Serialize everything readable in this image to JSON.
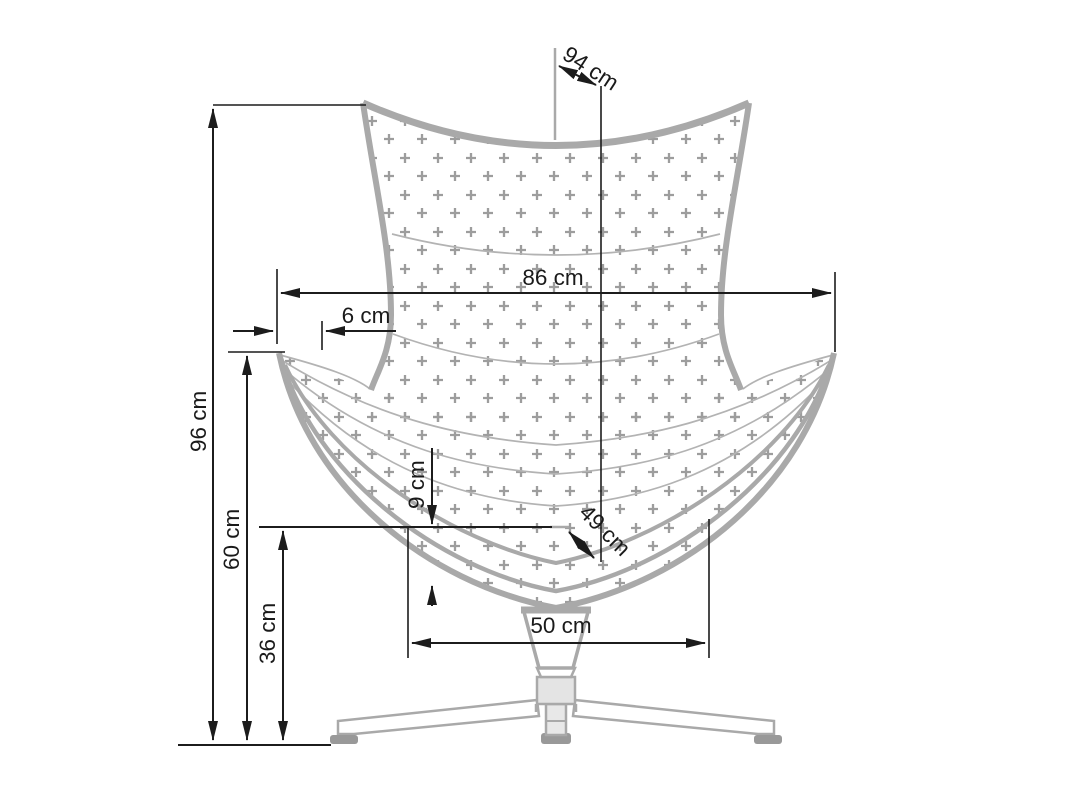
{
  "drawing": {
    "title": "Egg chair front-view dimension drawing",
    "labels": {
      "total_height": "96 cm",
      "back_width": "86 cm",
      "total_depth": "94 cm",
      "armrest_height": "60 cm",
      "seat_height": "36 cm",
      "armrest_offset": "6 cm",
      "cushion_thickness": "9 cm",
      "seat_depth": "49 cm",
      "base_width": "50 cm"
    },
    "colors": {
      "background": "#ffffff",
      "chair_outline": "#a9a9a9",
      "chair_seam": "#b3b3b3",
      "quilt_pattern": "#9d9d9d",
      "base_fill": "#e4e4e4",
      "foot_pad": "#999999",
      "dimension_line": "#1c1c1c",
      "text": "#1a1a1a"
    }
  }
}
